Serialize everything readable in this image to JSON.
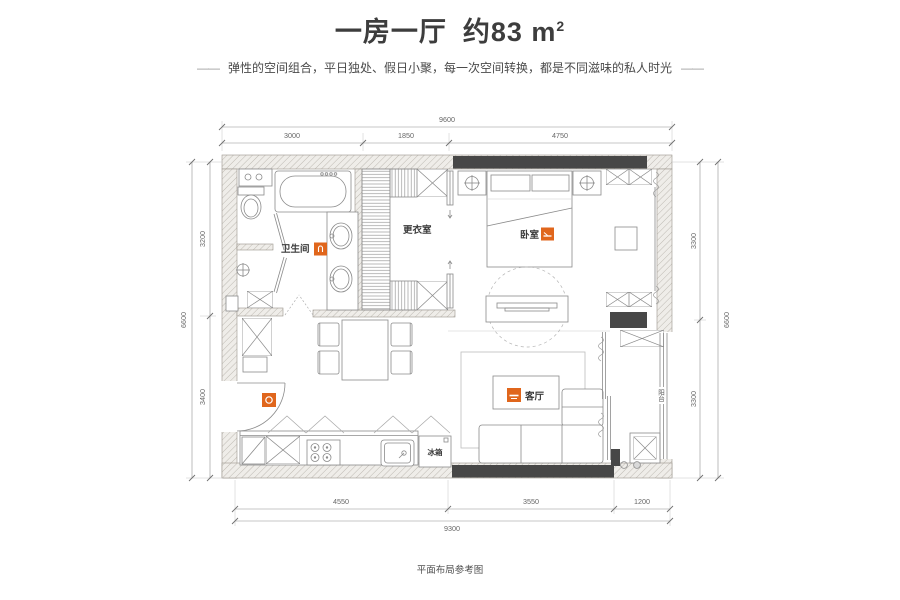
{
  "header": {
    "title_name": "一房一厅",
    "title_area": "约83 m",
    "title_area_sup": "2",
    "dash": "——",
    "subtitle": "弹性的空间组合，平日独处、假日小聚，每一次空间转换，都是不同滋味的私人时光"
  },
  "rooms": {
    "bathroom": "卫生间",
    "dressing_room": "更衣室",
    "bedroom": "卧室",
    "living_room": "客厅",
    "fridge": "冰箱",
    "balcony": "阳台"
  },
  "dimensions": {
    "top": {
      "total": "9600",
      "segments": [
        "3000",
        "1850",
        "4750"
      ]
    },
    "bottom": {
      "total": "9300",
      "segments": [
        "4550",
        "3550",
        "1200"
      ]
    },
    "left": {
      "total": "6600",
      "segments": [
        "3200",
        "3400"
      ]
    },
    "right": {
      "total": "6600",
      "segments": [
        "3300",
        "3300"
      ]
    }
  },
  "footer": {
    "caption": "平面布局参考图"
  },
  "colors": {
    "accent": "#E0661C",
    "wall_dark": "#474747"
  }
}
